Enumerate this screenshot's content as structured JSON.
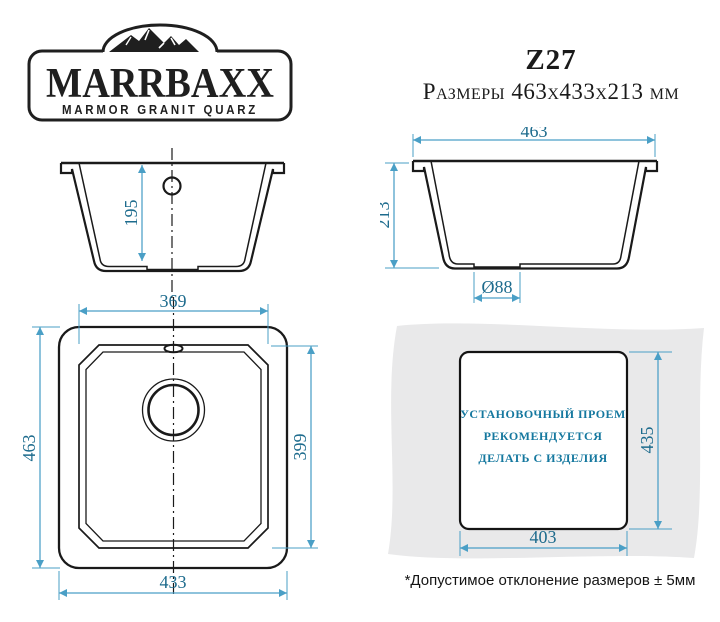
{
  "header": {
    "brand": "MARRBAXX",
    "brand_subtitle": "MARMOR GRANIT QUARZ",
    "model": "Z27",
    "size_line": "Размеры 463х433х213 мм"
  },
  "drawings": {
    "side_section": {
      "depth": "195"
    },
    "front_section": {
      "width": "463",
      "height": "213",
      "drain_diameter": "Ø88"
    },
    "top_view": {
      "bowl_width": "369",
      "outer_depth": "463",
      "bowl_depth": "399",
      "outer_width": "433"
    },
    "cutout": {
      "depth": "435",
      "width": "403",
      "note": [
        "УСТАНОВОЧНЫЙ ПРОЕМ",
        "РЕКОМЕНДУЕТСЯ",
        "ДЕЛАТЬ С ИЗДЕЛИЯ"
      ]
    }
  },
  "footnote": "*Допустимое отклонение размеров ± 5мм",
  "colors": {
    "line": "#1a1a1a",
    "dimension_line": "#4a9fc6",
    "dimension_text": "#1d6b8d",
    "teal_text": "#15789f",
    "countertop": "#e9e9ea"
  }
}
